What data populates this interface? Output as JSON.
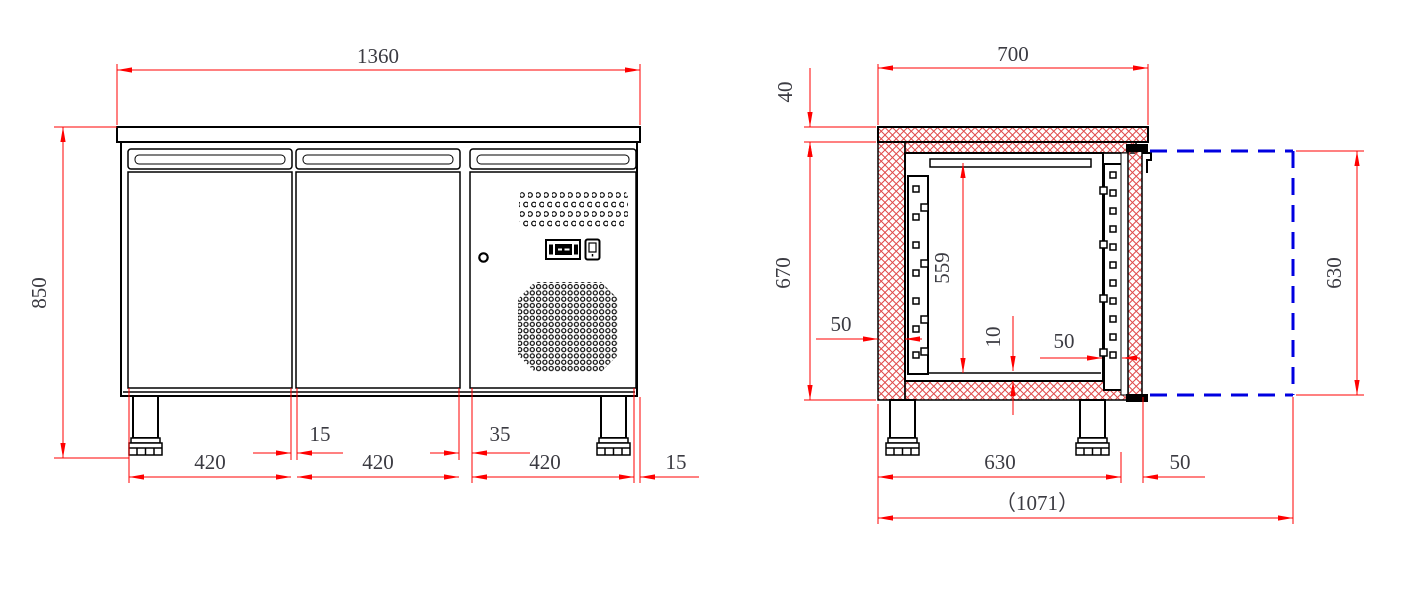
{
  "drawing": {
    "title": "refrigerated-counter-technical-drawing",
    "colors": {
      "dimension_line": "#ff0000",
      "door_swing_line": "#0000e0",
      "hatch": "#e04b4b",
      "outline": "#000000"
    },
    "front_view": {
      "width_total": "1360",
      "height_total": "850",
      "door1_width": "420",
      "gap1": "15",
      "door2_width": "420",
      "gap2": "35",
      "door3_width": "420",
      "edge_offset": "15"
    },
    "side_view": {
      "depth_top": "700",
      "worktop_thickness": "40",
      "body_height": "670",
      "interior_height": "559",
      "wall_thickness": "50",
      "floor_plate": "10",
      "rail_gap": "50",
      "body_depth": "630",
      "door_thickness": "50",
      "total_depth_open": "（1071）",
      "door_open_height": "630"
    }
  }
}
